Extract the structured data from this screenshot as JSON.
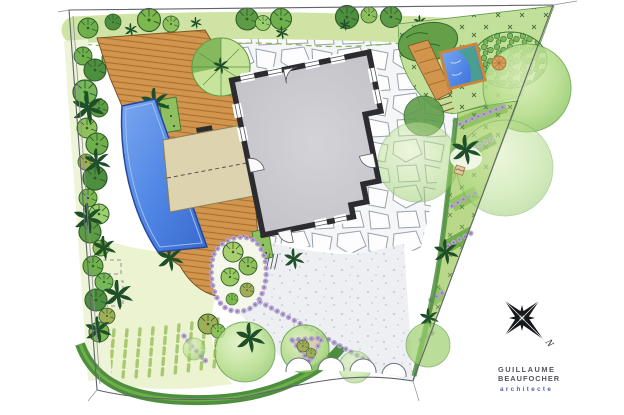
{
  "signature": {
    "line1": "GUILLAUME",
    "line2": "BEAUFOCHER",
    "line3": "architecte"
  },
  "compass": {
    "north_label": "N"
  },
  "palette": {
    "paper": "#ffffff",
    "boundary": "#60656c",
    "deck": "#d2954e",
    "deck_stripe": "#a8702e",
    "pergola": "#ddd3ae",
    "pool": "#4e84e4",
    "pond_teal": "#4aa08e",
    "house_wall": "#2c2c30",
    "house_floor": "#c8c8cd",
    "gravel": "#edeff3",
    "hedge_light": "#cfe4a4",
    "hedge_dark": "#4e8f3f",
    "canopy": "#a9d87c",
    "lawn": "#ecf3d0",
    "lavender": "#b4a3d2",
    "lavender_dark": "#8d77ad",
    "palm": "#1f4f28",
    "sand": "#d8cfae",
    "signature_text": "#53545c",
    "signature_accent": "#4d5cb5"
  }
}
